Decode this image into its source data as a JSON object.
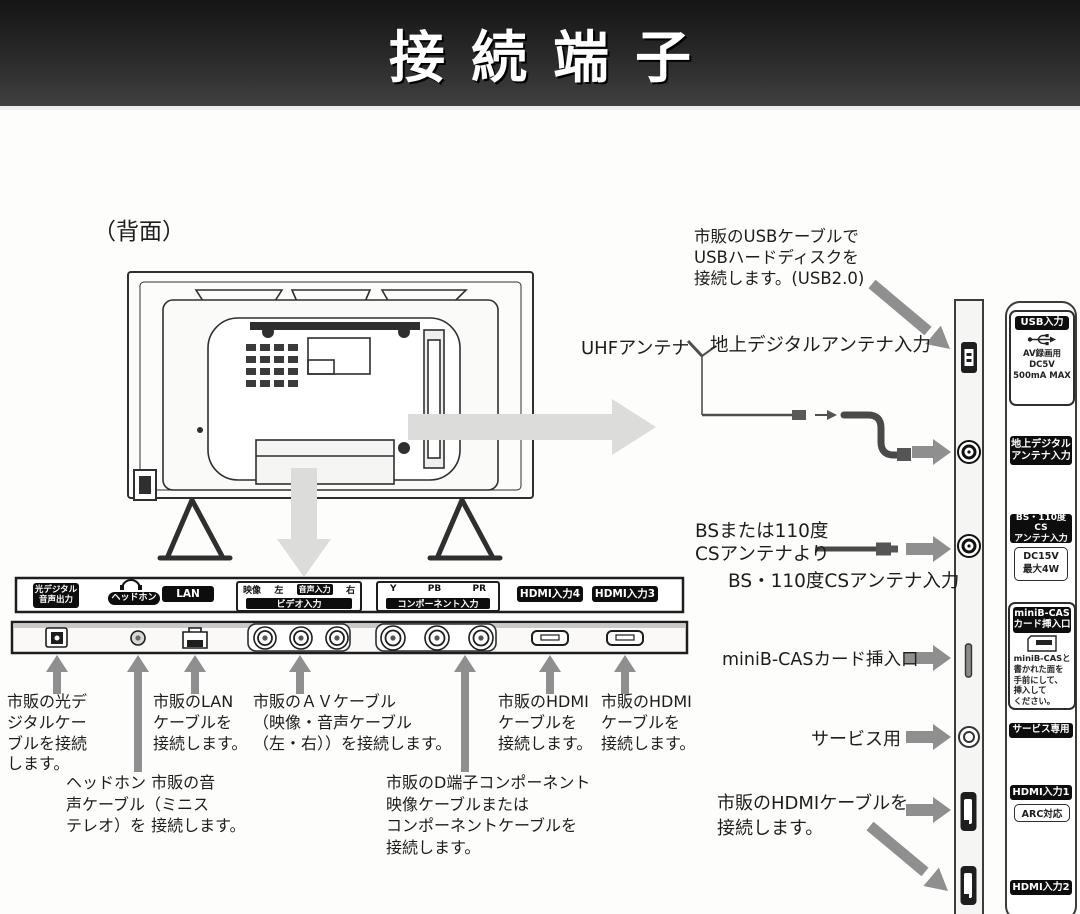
{
  "page": {
    "title": "接続端子",
    "rear_view": "（背面）"
  },
  "upper": {
    "usb_note": "市販のUSBケーブルで\nUSBハードディスクを\n接続します。(USB2.0)",
    "uhf": "UHFアンテナ",
    "terrestrial_input": "地上デジタルアンテナ入力",
    "bs_source": "BSまたは110度\nCSアンテナより",
    "bs_input": "BS・110度CSアンテナ入力",
    "minibcas": "miniB-CASカード挿入口",
    "service": "サービス用",
    "hdmi_note": "市販のHDMIケーブルを\n接続します。"
  },
  "legend": {
    "usb_label": "USB入力",
    "usb_icon": "usb-icon",
    "usb_detail": "AV録画用\nDC5V\n500mA MAX",
    "terrestrial_label": "地上デジタル\nアンテナ入力",
    "bs_label": "BS・110度CS\nアンテナ入力",
    "bs_detail": "DC15V\n最大4W",
    "minibcas_label": "miniB-CAS\nカード挿入口",
    "minibcas_icon": "b-cas-card-icon",
    "minibcas_note": "miniB-CASと\n書かれた面を\n手前にして、\n挿入して\nください。",
    "service_label": "サービス専用",
    "hdmi1_label": "HDMI入力1",
    "hdmi1_detail": "ARC対応",
    "hdmi2_label": "HDMI入力2"
  },
  "panel": {
    "optical": "光デジタル\n音声出力",
    "headphone": "ヘッドホン",
    "headphone_icon": "headphone-icon",
    "lan": "LAN",
    "video": {
      "v": "映像",
      "l": "左",
      "audio": "音声入力",
      "r": "右",
      "bar": "ビデオ入力"
    },
    "component": {
      "y": "Y",
      "pb": "PB",
      "pr": "PR",
      "bar": "コンポーネント入力"
    },
    "hdmi4": "HDMI入力4",
    "hdmi3": "HDMI入力3"
  },
  "notes": {
    "optical": "市販の光デ\nジタルケー\nブルを接続\nします。",
    "headphone": "ヘッドホン 市販の音\n声ケーブル（ミニス\nテレオ）を 接続します。",
    "lan": "市販のLAN\nケーブルを\n接続します。",
    "av": "市販のＡＶケーブル\n（映像・音声ケーブル\n（左・右））を接続します。",
    "component": "市販のD端子コンポーネント\n映像ケーブルまたは\nコンポーネントケーブルを\n接続します。",
    "hdmi4": "市販のHDMI\nケーブルを\n接続します。",
    "hdmi3": "市販のHDMI\nケーブルを\n接続します。"
  },
  "colors": {
    "arrow_dark": "#8f8f8f",
    "arrow_light": "#dcdcda",
    "chip_bg": "#0d0d0d"
  }
}
